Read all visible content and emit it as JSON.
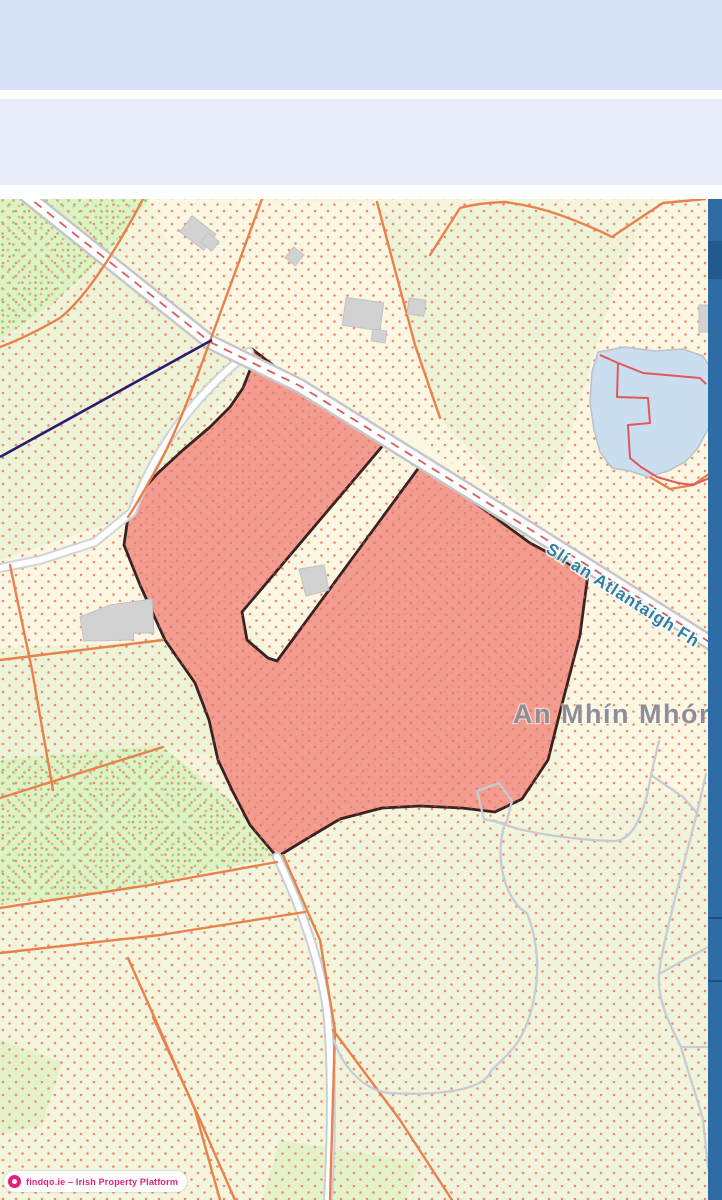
{
  "header": {
    "band1_color": "#d6e1f8",
    "band2_color": "#e9edf9"
  },
  "map": {
    "road_label": "Slí an Atlantaigh Fh",
    "townland_label": "An Mhín Mhór",
    "colors": {
      "property_fill": "#f19184",
      "property_outline": "#3a2222",
      "field_boundary": "#e8814c",
      "townland_boundary": "#e05858",
      "water": "#cadef0",
      "road_fill": "#ffffff",
      "road_casing": "#c6c6c6",
      "trail": "#c6ccd2",
      "building": "#d2d2d2",
      "background_cream": "#fbf7e2",
      "background_green": "#edf3d7",
      "background_bright_green": "#e0f1c6",
      "navy_line": "#2b1a70",
      "scroll_strip": "#2e6ca6"
    }
  },
  "attribution": {
    "badge_text": "findqo.ie – Irish Property Platform",
    "badge_color": "#e91e78",
    "badge_icon": "findqo-logo-icon"
  }
}
